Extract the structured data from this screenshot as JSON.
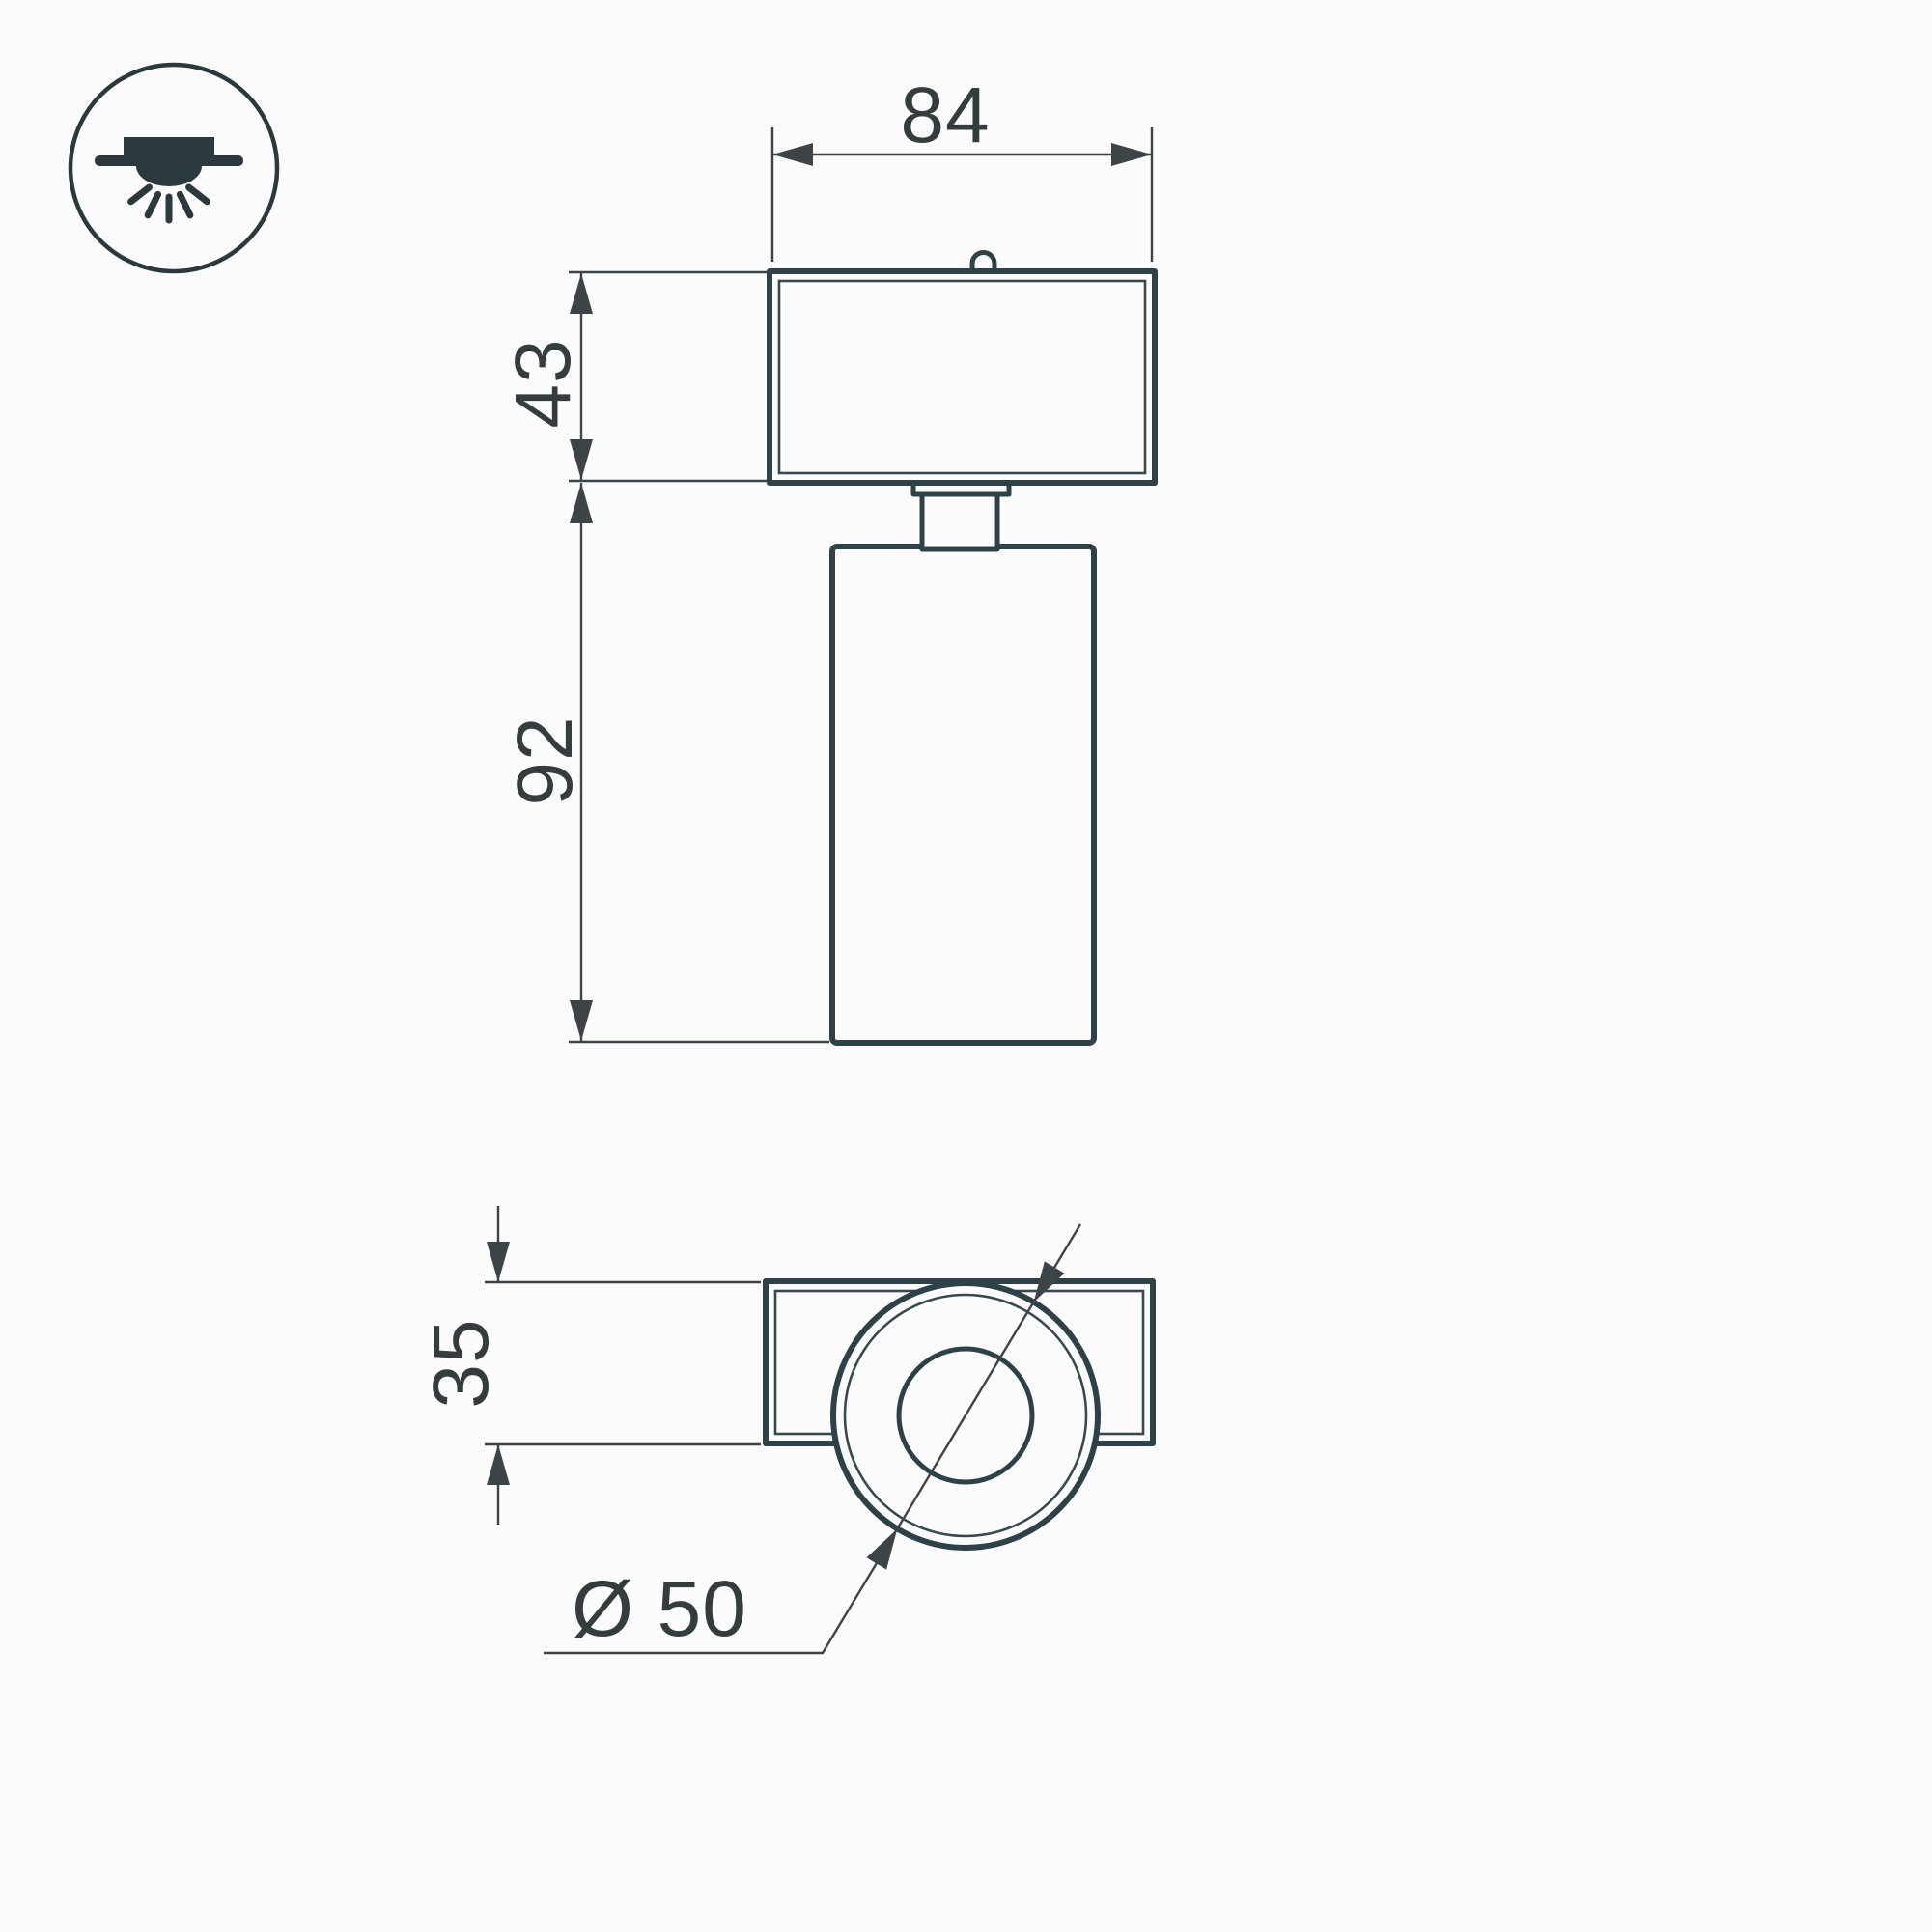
{
  "drawing": {
    "type": "luminaire-dimension-drawing",
    "dimensions": {
      "head_width": "84",
      "head_height": "43",
      "body_height": "92",
      "bracket_depth": "35",
      "diameter": "Ø 50"
    },
    "icon": {
      "name": "surface-ceiling-mount-icon"
    }
  },
  "colors": {
    "background": "#fbfbfb",
    "line": "#2e4146",
    "line_thin": "#37494d",
    "dim": "#3c4447",
    "text": "#343c3e",
    "icon": "#2b393c"
  }
}
